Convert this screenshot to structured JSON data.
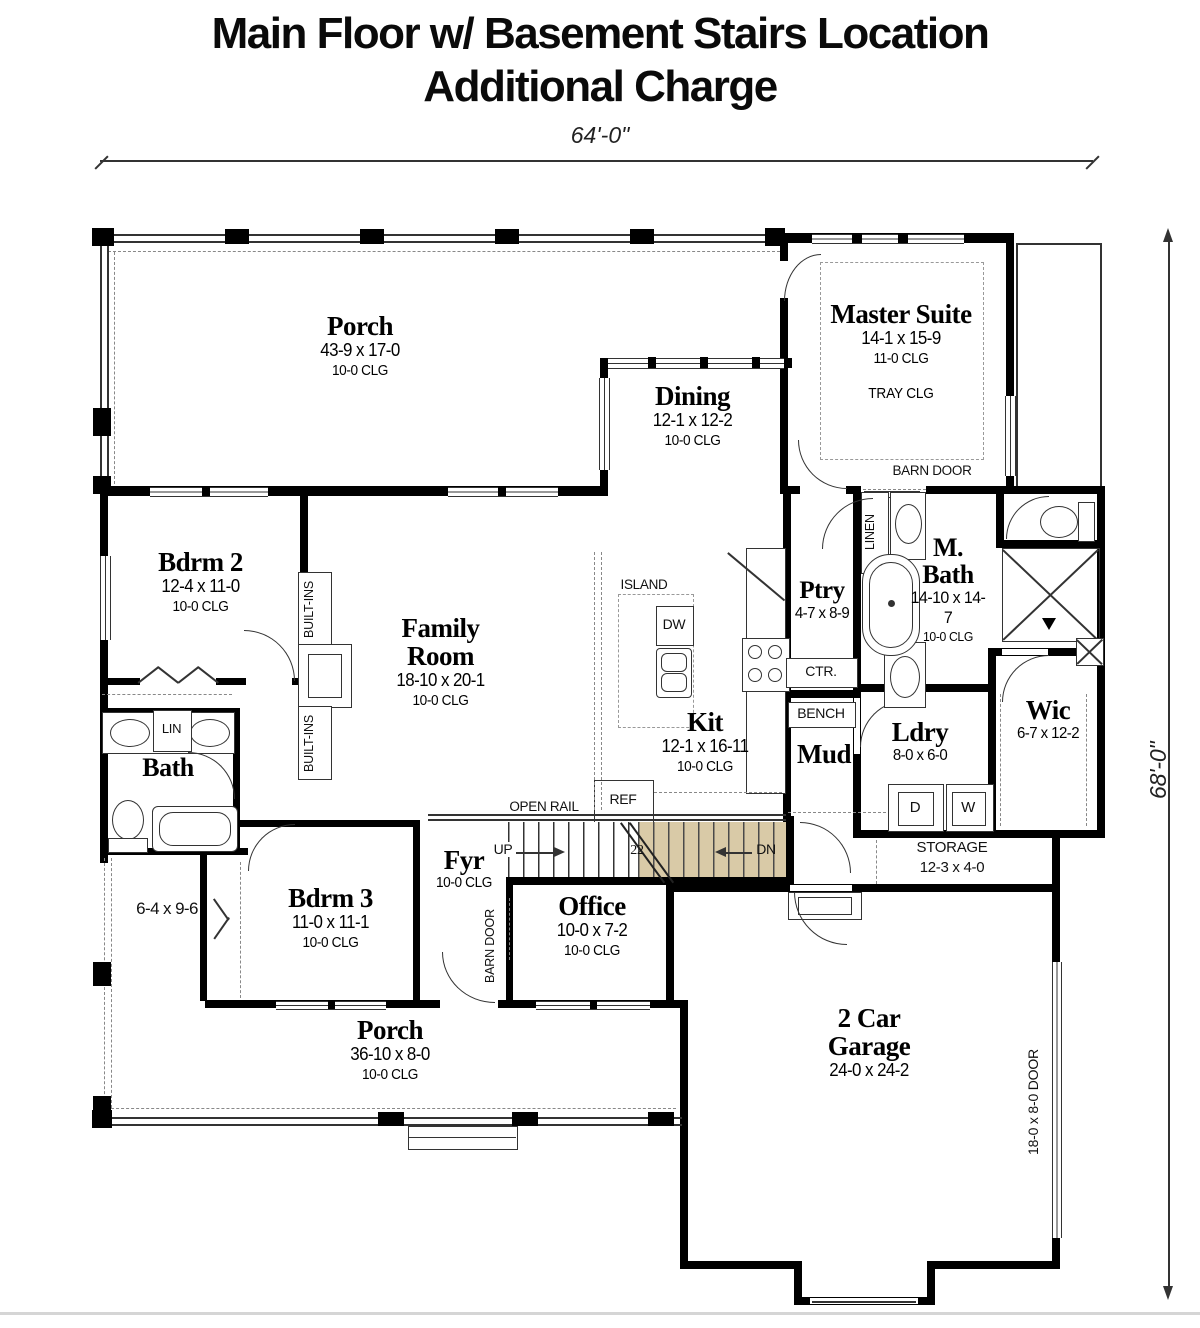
{
  "title": [
    "Main Floor w/ Basement Stairs Location",
    "Additional Charge"
  ],
  "dims": {
    "overall_width": "64'-0\"",
    "overall_height": "68'-0\"",
    "garage_door": "18-0 x 8-0 DOOR"
  },
  "rooms": {
    "porch_top": {
      "name": "Porch",
      "size": "43-9 x 17-0",
      "clg": "10-0 CLG"
    },
    "master_suite": {
      "name": "Master Suite",
      "size": "14-1 x 15-9",
      "clg": "11-0 CLG",
      "note": "TRAY CLG"
    },
    "dining": {
      "name": "Dining",
      "size": "12-1 x 12-2",
      "clg": "10-0 CLG"
    },
    "bdrm2": {
      "name": "Bdrm 2",
      "size": "12-4 x 11-0",
      "clg": "10-0 CLG"
    },
    "family_room": {
      "name": "Family Room",
      "size": "18-10 x 20-1",
      "clg": "10-0 CLG"
    },
    "kitchen": {
      "name": "Kit",
      "size": "12-1 x 16-11",
      "clg": "10-0 CLG"
    },
    "pantry": {
      "name": "Ptry",
      "size": "4-7 x 8-9"
    },
    "master_bath": {
      "name": "M. Bath",
      "size": "14-10 x 14-7",
      "clg": "10-0 CLG"
    },
    "wic": {
      "name": "Wic",
      "size": "6-7 x 12-2"
    },
    "laundry": {
      "name": "Ldry",
      "size": "8-0 x 6-0"
    },
    "mud": {
      "name": "Mud"
    },
    "bath": {
      "name": "Bath"
    },
    "bdrm3": {
      "name": "Bdrm 3",
      "size": "11-0 x 11-1",
      "clg": "10-0 CLG"
    },
    "foyer": {
      "name": "Fyr",
      "clg": "10-0 CLG"
    },
    "office": {
      "name": "Office",
      "size": "10-0 x 7-2",
      "clg": "10-0 CLG"
    },
    "porch_bottom": {
      "name": "Porch",
      "size": "36-10 x 8-0",
      "clg": "10-0 CLG"
    },
    "garage": {
      "name": "2 Car Garage",
      "size": "24-0 x 24-2"
    },
    "storage": {
      "name": "STORAGE",
      "size": "12-3 x 4-0"
    },
    "side_porch": {
      "size": "6-4 x 9-6"
    }
  },
  "labels": {
    "island": "ISLAND",
    "dw": "DW",
    "ref": "REF",
    "ctr": "CTR.",
    "bench": "BENCH",
    "lin": "LIN",
    "linen": "LINEN",
    "built_ins": "BUILT-INS",
    "barn_door": "BARN DOOR",
    "open_rail": "OPEN RAIL",
    "up": "UP",
    "dn": "DN",
    "dryer": "D",
    "washer": "W",
    "stair_note": "22"
  },
  "colors": {
    "wall": "#000000",
    "basement_stair_shade": "#d9caa7",
    "line": "#333333"
  }
}
